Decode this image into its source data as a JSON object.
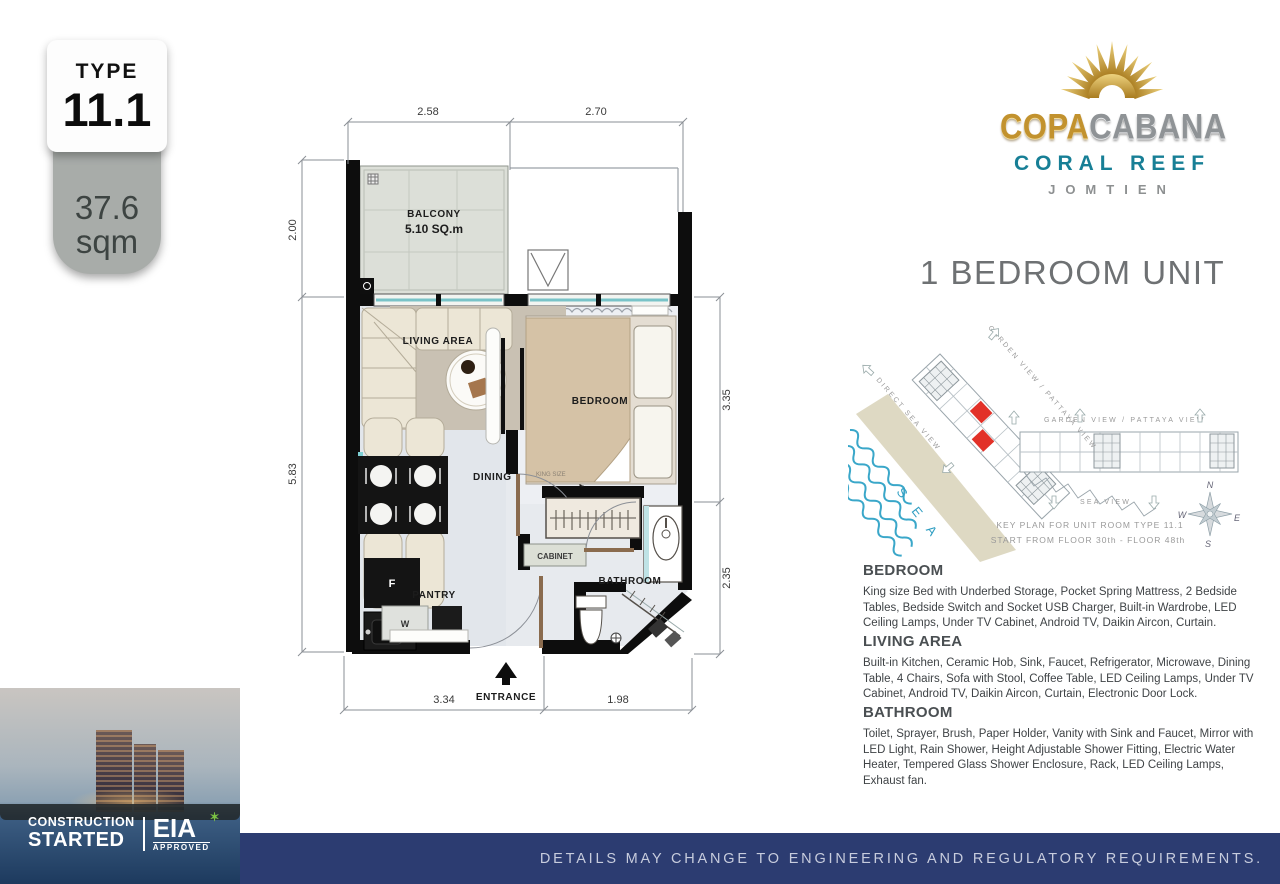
{
  "badge": {
    "label": "TYPE",
    "value": "11.1",
    "area": "37.6",
    "area_unit": "sqm"
  },
  "brand": {
    "name_gold": "COPA",
    "name_silver": "CABANA",
    "line2": "CORAL REEF",
    "line3": "JOMTIEN"
  },
  "heading": "1 BEDROOM UNIT",
  "plan": {
    "rooms": {
      "balcony": "BALCONY",
      "balcony_area": "5.10 SQ.m",
      "living": "LIVING AREA",
      "dining": "DINING",
      "interior_area": "32.50 SQ.m",
      "bedroom": "BEDROOM",
      "bed_size": "KING SIZE",
      "cabinet": "CABINET",
      "bathroom": "BATHROOM",
      "pantry": "PANTRY",
      "entrance": "ENTRANCE",
      "fridge": "F",
      "washer": "W"
    },
    "dims": {
      "top_left": "2.58",
      "top_right": "2.70",
      "left_top": "2.00",
      "left_bottom": "5.83",
      "right_top": "3.35",
      "right_bottom": "2.35",
      "bottom_left": "3.34",
      "bottom_right": "1.98"
    }
  },
  "keyplan": {
    "diag_label": "GARDEN VIEW / PATTAYA VIEW",
    "direct_sea": "DIRECT SEA VIEW",
    "garden_view": "GARDEN VIEW / PATTAYA VIEW",
    "sea_view": "SEA VIEW",
    "sea_word": "S E A",
    "caption1": "KEY PLAN FOR UNIT ROOM TYPE 11.1",
    "caption2": "START FROM FLOOR 30th - FLOOR 48th",
    "compass": {
      "n": "N",
      "e": "E",
      "s": "S",
      "w": "W"
    }
  },
  "specs": [
    {
      "title": "BEDROOM",
      "body": "King size Bed with Underbed Storage, Pocket Spring Mattress, 2 Bedside Tables, Bedside Switch and Socket USB Charger, Built-in Wardrobe, LED Ceiling Lamps, Under TV Cabinet, Android TV, Daikin Aircon, Curtain."
    },
    {
      "title": "LIVING AREA",
      "body": "Built-in Kitchen, Ceramic Hob, Sink, Faucet, Refrigerator, Microwave, Dining Table, 4 Chairs, Sofa with Stool, Coffee Table, LED Ceiling Lamps, Under TV Cabinet, Android TV, Daikin Aircon, Curtain, Electronic Door Lock."
    },
    {
      "title": "BATHROOM",
      "body": "Toilet, Sprayer, Brush, Paper Holder, Vanity with Sink and Faucet, Mirror with LED Light, Rain Shower, Height Adjustable Shower Fitting, Electric Water Heater, Tempered Glass Shower Enclosure, Rack, LED Ceiling Lamps, Exhaust fan."
    }
  ],
  "footer": {
    "disclaimer": "DETAILS MAY CHANGE TO ENGINEERING AND REGULATORY REQUIREMENTS.",
    "construction_line1": "CONSTRUCTION",
    "construction_line2": "STARTED",
    "eia": "EIA",
    "eia_sub": "APPROVED"
  },
  "colors": {
    "navy": "#2c3c71",
    "gold": "#c2922e",
    "brand_teal": "#177f96",
    "unit_red": "#e23128",
    "sea_blue": "#3aa7c9"
  }
}
